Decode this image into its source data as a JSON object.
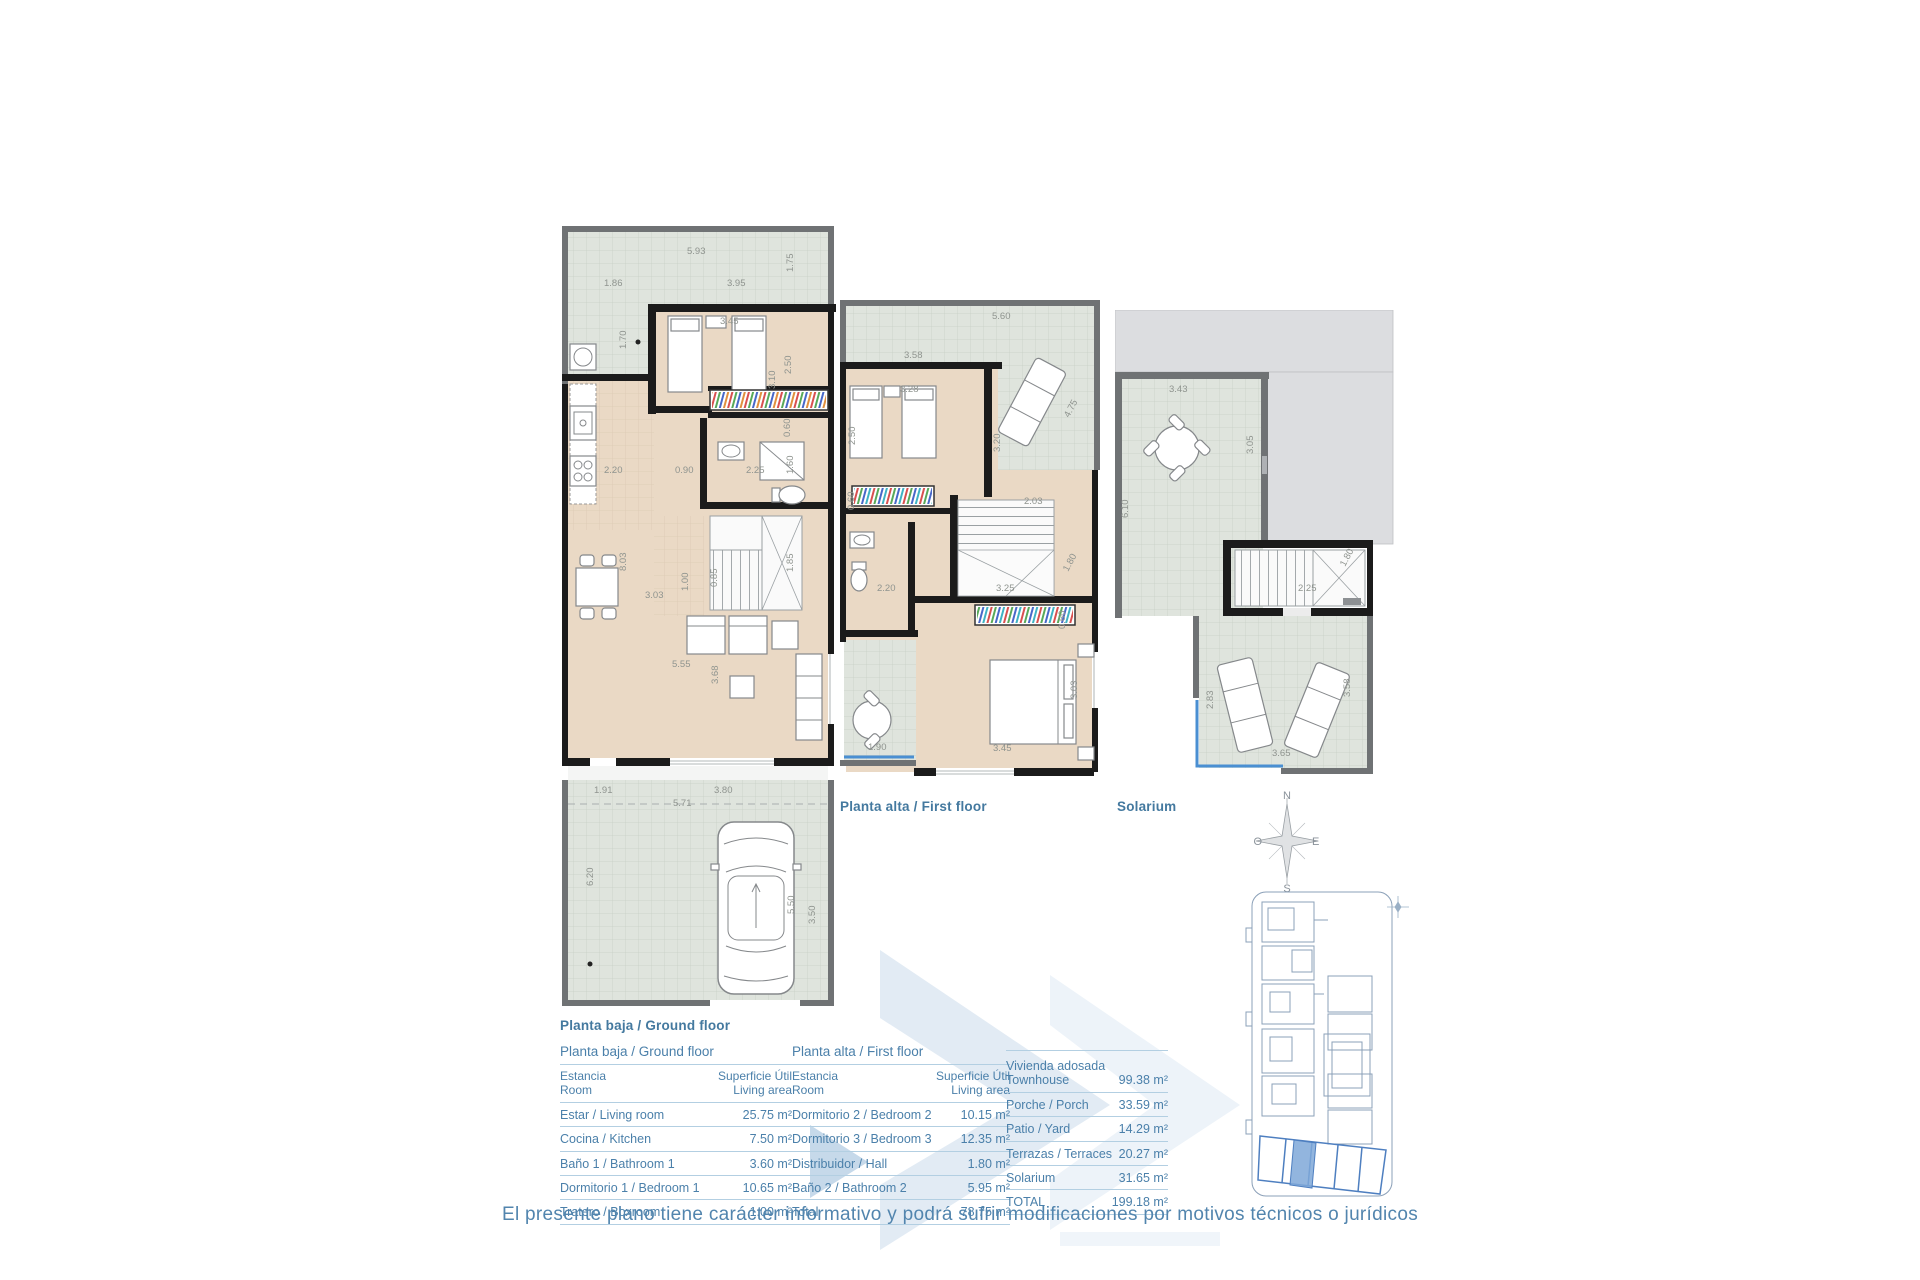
{
  "plans": {
    "ground": {
      "caption": "Planta baja / Ground floor",
      "dims": [
        "5.93",
        "1.75",
        "1.86",
        "3.95",
        "3.45",
        "2.50",
        "3.10",
        "1.70",
        "2.20",
        "0.90",
        "2.25",
        "1.60",
        "0.60",
        "8.03",
        "3.03",
        "1.00",
        "0.85",
        "1.85",
        "5.55",
        "3.68",
        "1.91",
        "3.80",
        "5.71",
        "6.20",
        "5.50",
        "3.50"
      ]
    },
    "first": {
      "caption": "Planta alta / First floor",
      "dims": [
        "5.60",
        "3.58",
        "2.50",
        "3.28",
        "4.75",
        "3.20",
        "2.03",
        "0.60",
        "2.20",
        "3.25",
        "1.80",
        "0.60",
        "3.03",
        "3.45",
        "1.90"
      ]
    },
    "solarium": {
      "caption": "Solarium",
      "dims": [
        "3.43",
        "3.05",
        "6.10",
        "2.25",
        "1.80",
        "2.83",
        "3.65",
        "3.58"
      ]
    }
  },
  "compass": {
    "north": "N",
    "south": "S",
    "east": "E",
    "west": "O"
  },
  "tables": {
    "header": {
      "room_es": "Estancia",
      "room_en": "Room",
      "area_es": "Superficie Útil",
      "area_en": "Living area"
    },
    "ground": {
      "title": "Planta baja / Ground floor",
      "rows": [
        {
          "label": "Estar / Living room",
          "value": "25.75 m²"
        },
        {
          "label": "Cocina / Kitchen",
          "value": "7.50 m²"
        },
        {
          "label": "Baño 1 / Bathroom 1",
          "value": "3.60 m²"
        },
        {
          "label": "Dormitorio 1 / Bedroom 1",
          "value": "10.65 m²"
        },
        {
          "label": "Tratero / Boxroom",
          "value": "1.00 m²"
        }
      ]
    },
    "first": {
      "title": "Planta alta / First floor",
      "rows": [
        {
          "label": "Dormitorio 2 / Bedroom 2",
          "value": "10.15 m²"
        },
        {
          "label": "Dormitorio 3 / Bedroom 3",
          "value": "12.35 m²"
        },
        {
          "label": "Distribuidor / Hall",
          "value": "1.80 m²"
        },
        {
          "label": "Baño 2 / Bathroom 2",
          "value": "5.95 m²"
        },
        {
          "label": "Total",
          "value": "78.75 m²"
        }
      ]
    },
    "summary": {
      "rows": [
        {
          "label": "Vivienda adosada\nTownhouse",
          "value": "99.38 m²"
        },
        {
          "label": "Porche / Porch",
          "value": "33.59 m²"
        },
        {
          "label": "Patio / Yard",
          "value": "14.29 m²"
        },
        {
          "label": "Terrazas / Terraces",
          "value": "20.27 m²"
        },
        {
          "label": "Solarium",
          "value": "31.65 m²"
        },
        {
          "label": "TOTAL",
          "value": "199.18 m²"
        }
      ]
    }
  },
  "footer": {
    "disclaimer": "El presente plano tiene carácter informativo y podrá sufrir modificaciones por motivos técnicos o jurídicos"
  }
}
